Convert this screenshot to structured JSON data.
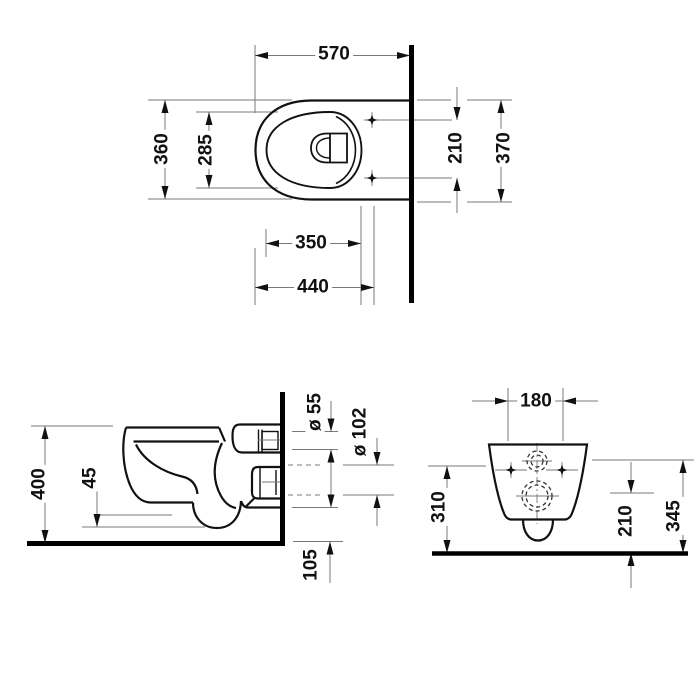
{
  "drawing": {
    "title": "wall-hung toilet technical dimension drawing",
    "views": {
      "top": "top-view",
      "side": "side-view",
      "front": "front-view"
    }
  },
  "dims": {
    "top": {
      "overall_length": "570",
      "overall_width": "360",
      "seat_opening_width": "285",
      "fixing_point_spacing": "210",
      "overall_width_incl_fixings": "370",
      "seat_opening_length": "350",
      "front_to_fixing": "440"
    },
    "side": {
      "rim_height": "400",
      "trap_clearance": "45",
      "inlet_diameter": "ø 55",
      "outlet_diameter": "ø 102",
      "outlet_bottom_to_floor": "105"
    },
    "front": {
      "fixing_hole_spacing": "180",
      "inlet_center_height": "310",
      "outlet_center_height": "210",
      "connection_height": "345"
    }
  },
  "colors": {
    "outline": "#111111",
    "dimension_line": "#7a7a7a",
    "arrow": "#111111",
    "text": "#111111",
    "background": "#ffffff"
  }
}
